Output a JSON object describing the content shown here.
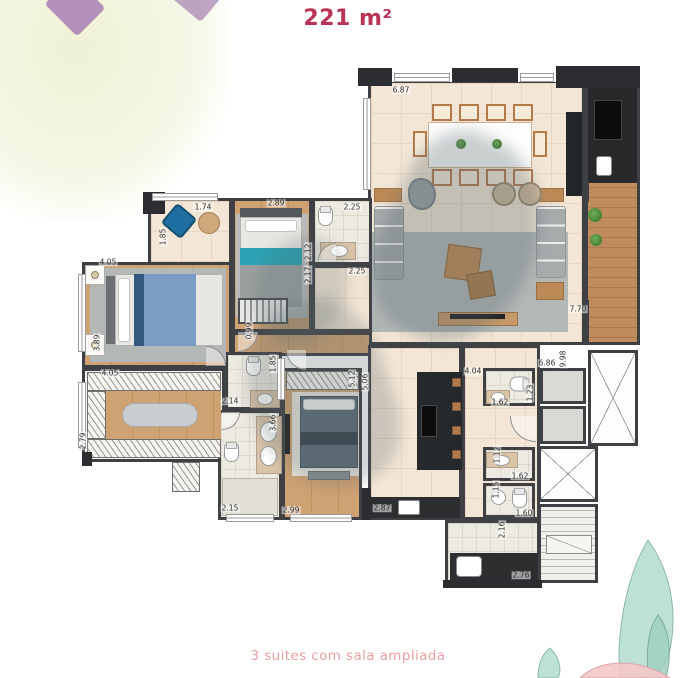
{
  "page": {
    "title": "221 m²",
    "caption": "3 suites com sala ampliada"
  },
  "colors": {
    "title_text": "#bb3357",
    "caption_text": "#ec9fa6",
    "wall": "#3f4044",
    "wood_floor": "#c89a6a",
    "beige_floor": "#f3e6d6",
    "tile_floor": "#edeae2",
    "rug_gray": "#b3b7b6",
    "accent_teal": "#2ba3b4",
    "bed_blue": "#7b9cc4",
    "island_dark": "#26292b",
    "watercolor_mint": "#aed9cb",
    "watercolor_pink": "#f5c6c8",
    "watercolor_moss": "#eef1d3",
    "watercolor_purple": "#9e6fae"
  },
  "plan": {
    "area_label": "221 m²",
    "dimensions": [
      {
        "text": "6.87",
        "x": 401,
        "y": 90,
        "vertical": false
      },
      {
        "text": "1.74",
        "x": 203,
        "y": 207,
        "vertical": false
      },
      {
        "text": "2.89",
        "x": 276,
        "y": 203,
        "vertical": false
      },
      {
        "text": "2.25",
        "x": 352,
        "y": 207,
        "vertical": false
      },
      {
        "text": "1.85",
        "x": 163,
        "y": 237,
        "vertical": true
      },
      {
        "text": "2.12",
        "x": 308,
        "y": 252,
        "vertical": true
      },
      {
        "text": "2.17",
        "x": 308,
        "y": 275,
        "vertical": true
      },
      {
        "text": "2.25",
        "x": 357,
        "y": 271,
        "vertical": false
      },
      {
        "text": "4.05",
        "x": 108,
        "y": 262,
        "vertical": false
      },
      {
        "text": "3.89",
        "x": 97,
        "y": 343,
        "vertical": true
      },
      {
        "text": "0.99",
        "x": 249,
        "y": 331,
        "vertical": true
      },
      {
        "text": "4.05",
        "x": 110,
        "y": 373,
        "vertical": false
      },
      {
        "text": "2.79",
        "x": 83,
        "y": 441,
        "vertical": true
      },
      {
        "text": "1.85",
        "x": 273,
        "y": 364,
        "vertical": true
      },
      {
        "text": "2.14",
        "x": 230,
        "y": 401,
        "vertical": false
      },
      {
        "text": "3.66",
        "x": 273,
        "y": 423,
        "vertical": true
      },
      {
        "text": "2.15",
        "x": 230,
        "y": 508,
        "vertical": false
      },
      {
        "text": "2.99",
        "x": 291,
        "y": 510,
        "vertical": false
      },
      {
        "text": "5.12",
        "x": 352,
        "y": 379,
        "vertical": true
      },
      {
        "text": "5.06",
        "x": 365,
        "y": 382,
        "vertical": true
      },
      {
        "text": "2.87",
        "x": 382,
        "y": 508,
        "vertical": false
      },
      {
        "text": "4.04",
        "x": 473,
        "y": 371,
        "vertical": false
      },
      {
        "text": "6.86",
        "x": 547,
        "y": 363,
        "vertical": false
      },
      {
        "text": "9.98",
        "x": 563,
        "y": 359,
        "vertical": true
      },
      {
        "text": "1.62",
        "x": 500,
        "y": 402,
        "vertical": false
      },
      {
        "text": "1.23",
        "x": 530,
        "y": 393,
        "vertical": true
      },
      {
        "text": "1.12",
        "x": 497,
        "y": 455,
        "vertical": true
      },
      {
        "text": "1.62",
        "x": 520,
        "y": 476,
        "vertical": false
      },
      {
        "text": "1.15",
        "x": 496,
        "y": 490,
        "vertical": true
      },
      {
        "text": "1.60",
        "x": 524,
        "y": 513,
        "vertical": false
      },
      {
        "text": "2.16",
        "x": 502,
        "y": 530,
        "vertical": true
      },
      {
        "text": "2.76",
        "x": 521,
        "y": 575,
        "vertical": false
      },
      {
        "text": "7.70",
        "x": 578,
        "y": 309,
        "vertical": false
      }
    ]
  }
}
